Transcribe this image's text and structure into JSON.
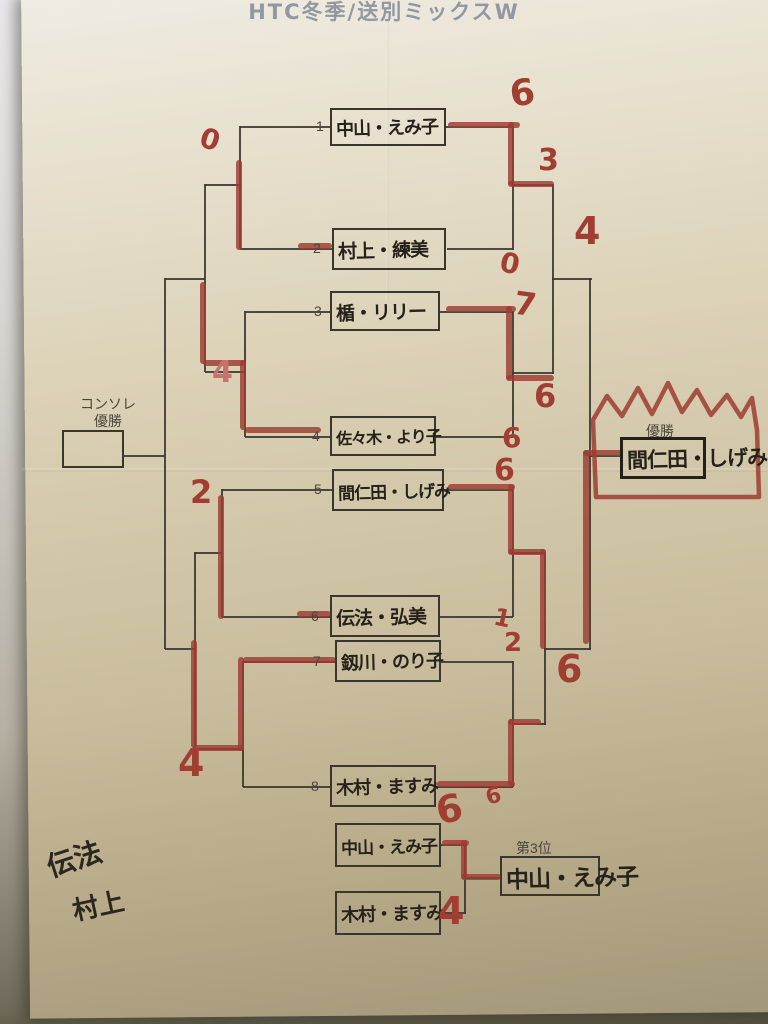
{
  "title": "HTC冬季/送別ミックスW",
  "console": {
    "label_line1": "コンソレ",
    "label_line2": "優勝"
  },
  "champion": {
    "label": "優勝",
    "name": "間仁田・しげみ"
  },
  "third_place": {
    "label": "第3位",
    "winner": "中山・えみ子",
    "top_name": "中山・えみ子",
    "bottom_name": "木村・ますみ"
  },
  "players": [
    {
      "seed": "1",
      "name": "中山・えみ子"
    },
    {
      "seed": "2",
      "name": "村上・練美"
    },
    {
      "seed": "3",
      "name": "楯・リリー"
    },
    {
      "seed": "4",
      "name": "佐々木・より子"
    },
    {
      "seed": "5",
      "name": "間仁田・しげみ"
    },
    {
      "seed": "6",
      "name": "伝法・弘美"
    },
    {
      "seed": "7",
      "name": "釼川・のり子"
    },
    {
      "seed": "8",
      "name": "木村・ますみ"
    }
  ],
  "memo": {
    "line1": "伝法",
    "line2": "村上"
  },
  "red_scores": [
    {
      "value": "6"
    },
    {
      "value": "3"
    },
    {
      "value": "0"
    },
    {
      "value": "0"
    },
    {
      "value": "4"
    },
    {
      "value": "7"
    },
    {
      "value": "4"
    },
    {
      "value": "6"
    },
    {
      "value": "6"
    },
    {
      "value": "6"
    },
    {
      "value": "2"
    },
    {
      "value": "1"
    },
    {
      "value": "2"
    },
    {
      "value": "6"
    },
    {
      "value": "4"
    },
    {
      "value": "6"
    },
    {
      "value": "6"
    },
    {
      "value": "4"
    }
  ],
  "colors": {
    "marker_red": "#9c3c33",
    "ink_black": "#2e2a23",
    "paper_tan": "#d2c7a9",
    "printed_gray": "#4b463b",
    "title_gray": "#9298a1"
  }
}
